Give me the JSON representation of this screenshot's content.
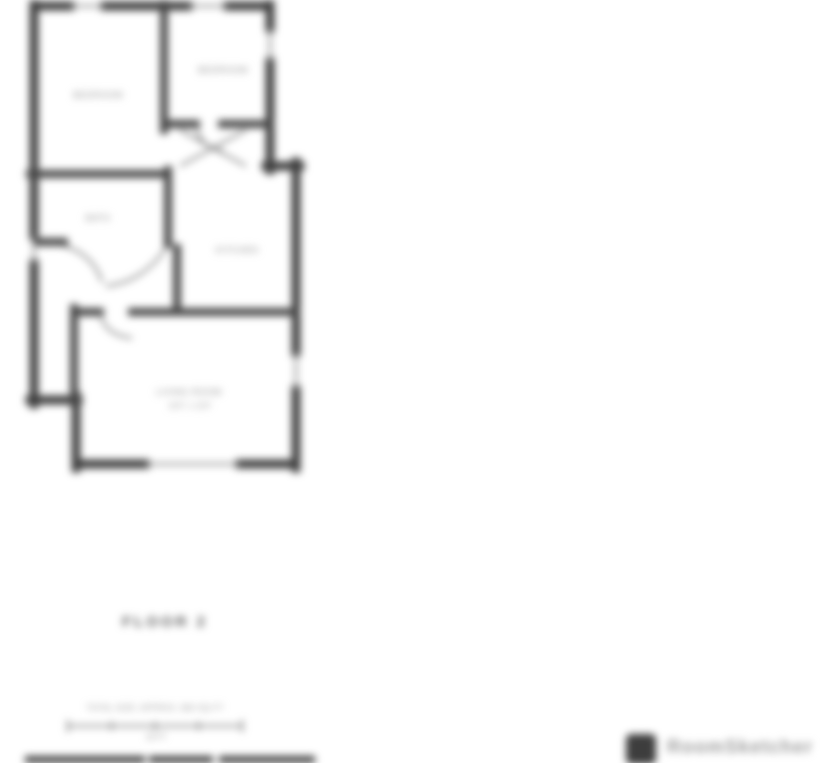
{
  "page": {
    "background": "#ffffff",
    "description": "Blurry real-estate floor plan export, upper floor plan with caption and scale bar, branding logo at bottom right, top edge of next floor plan visible at bottom"
  },
  "floor_plan": {
    "rooms": [
      {
        "id": "bedroom-1",
        "label": "BEDROOM"
      },
      {
        "id": "bedroom-2",
        "label": "BEDROOM"
      },
      {
        "id": "bath",
        "label": "BATH"
      },
      {
        "id": "kitchen",
        "label": "KITCHEN"
      },
      {
        "id": "living-room",
        "label": "LIVING ROOM",
        "dimensions": "19'0\" x 13'6\""
      }
    ],
    "caption": "FLOOR 2",
    "scale_bar": {
      "note": "TOTAL SIZE: APPROX. 860 SQ FT",
      "length_label": "16 FT"
    }
  },
  "branding": {
    "logo_icon": "floorplan-logo-icon",
    "wordmark": "RoomSketcher"
  },
  "colors": {
    "wall": "#3f3f3f",
    "thin_line": "#6f6f6f",
    "window_line": "#8a8a8a",
    "label_text": "#8f8f8f",
    "caption_text": "#5a5a5a",
    "logo_bg": "#3d3d3d",
    "wordmark_text": "#9c9c9c"
  }
}
